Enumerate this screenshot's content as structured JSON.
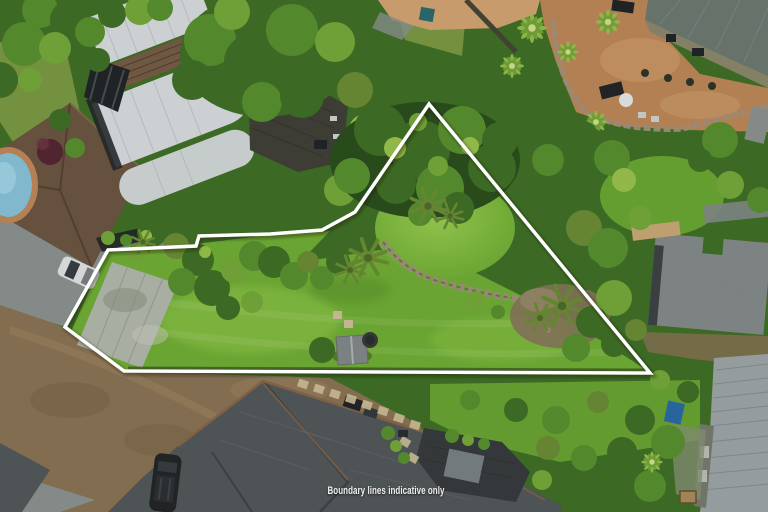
{
  "caption": {
    "text": "Boundary lines indicative only"
  },
  "boundary": {
    "points": "429,104 650,373 124,371 65,327 108,250 196,246 199,236 270,234 322,230 355,212",
    "color": "#ffffff",
    "stroke_width_px": 3.5
  },
  "colors": {
    "boundary": "#ffffff",
    "caption": "#f0f0ef",
    "lawn": "#74ad39",
    "lawnLight": "#9ac955",
    "lawnOlive": "#7d9b47",
    "veg1": "#2f5420",
    "veg2": "#44732a",
    "veg3": "#5d9234",
    "veg4": "#79a83f",
    "veg5": "#9bbf52",
    "veg6": "#6f8f3a",
    "dirt": "#8d7759",
    "dirtLight": "#a08a66",
    "pavement": "#8e9492",
    "concretePad": "#b2b6ab",
    "whiteRoof": "#d2d6d8",
    "brownRoof": "#6f5a45",
    "cedar": "#7a6149",
    "deck": "#45453d",
    "glass": "#24292b",
    "spa": "#46504b",
    "pool": "#8cc0d4",
    "terracotta": "#bb8a5c",
    "terracottaLight": "#cda476",
    "stone": "#a29380",
    "roofTopRight": "#717d74",
    "roofMidRight": "#868d8c",
    "roofBottomRight": "#9fa5a6",
    "roofBottom": "#575c5f",
    "roofBottomLight": "#8a9093",
    "ridgeCap": "#8a6b4f",
    "deckDark": "#3b4042",
    "carDark": "#26292b",
    "carWhite": "#d9dbdc",
    "carBlue": "#2f6ea6",
    "shedRoof": "#858b8d"
  }
}
